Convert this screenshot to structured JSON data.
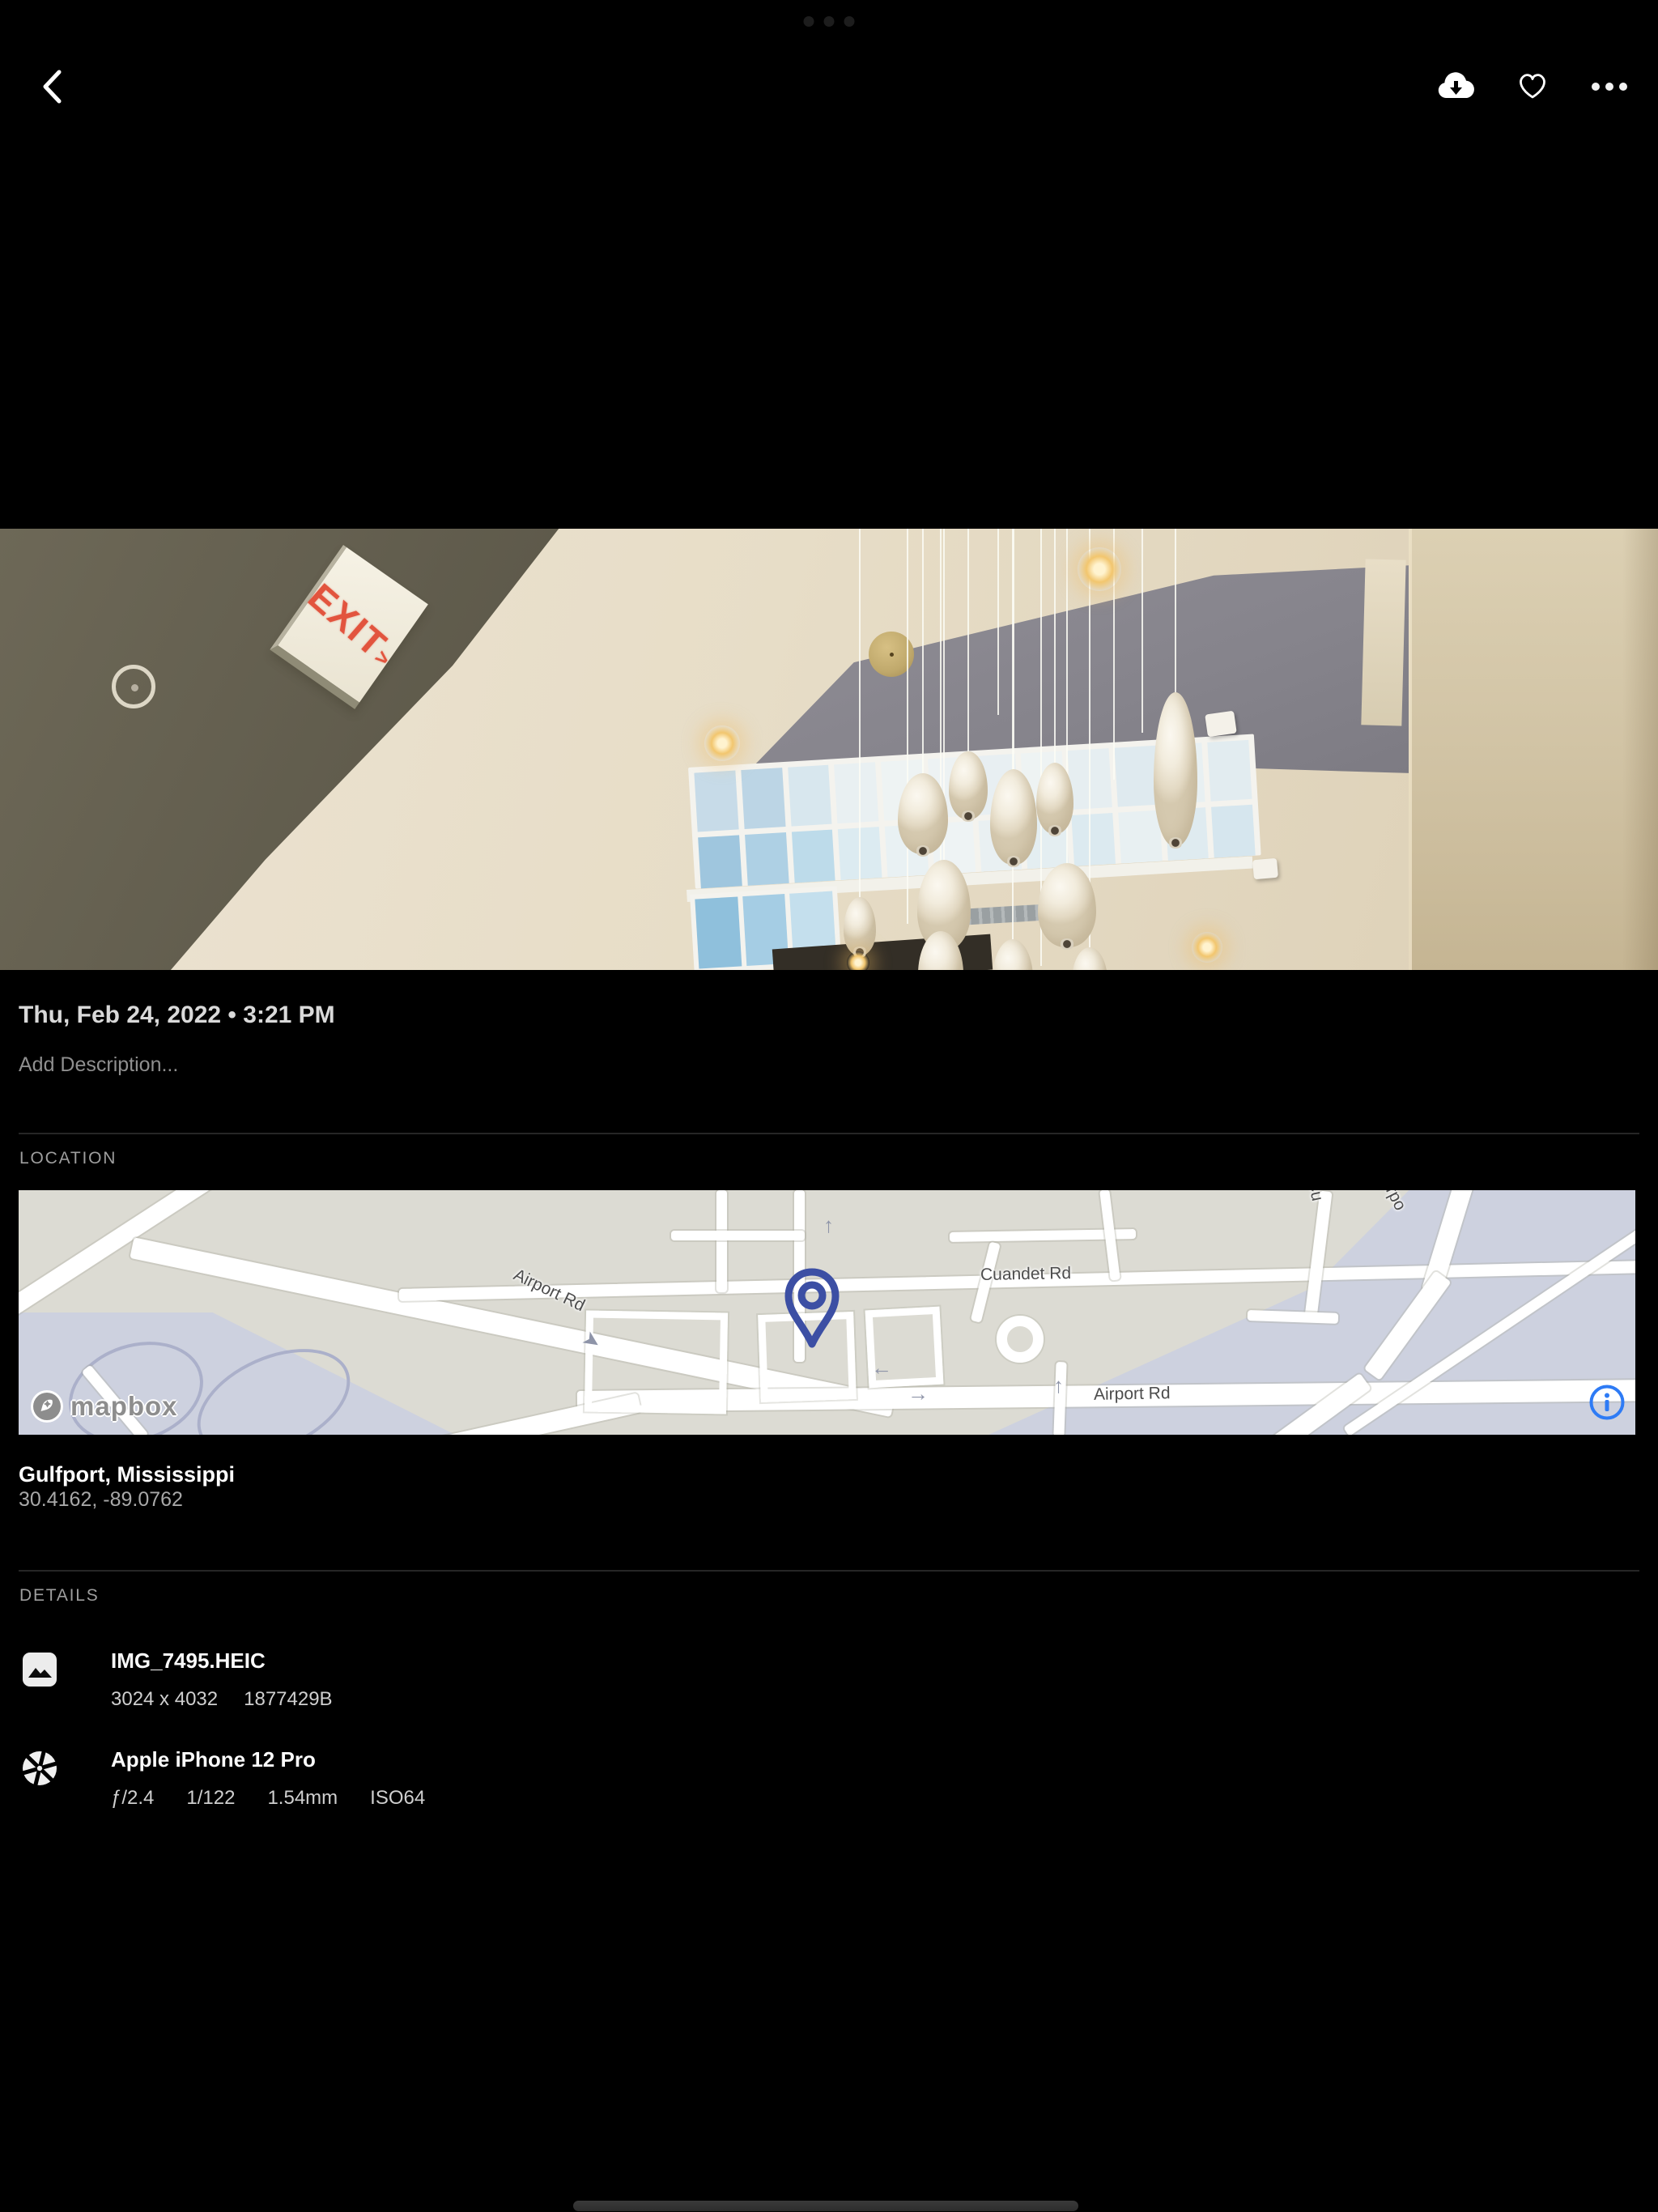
{
  "top_bar": {
    "back_icon": "chevron-left",
    "download_icon": "cloud-download",
    "favorite_icon": "heart-outline",
    "more_icon": "ellipsis"
  },
  "photo": {
    "exit_sign_text": "EXIT",
    "exit_sign_arrow": ">"
  },
  "metadata": {
    "date_time": "Thu, Feb 24, 2022 • 3:21 PM",
    "description_placeholder": "Add Description..."
  },
  "location": {
    "section_label": "LOCATION",
    "place": "Gulfport, Mississippi",
    "coordinates": "30.4162, -89.0762",
    "map": {
      "road_labels": [
        "Airport Rd",
        "Cuandet Rd",
        "Airport Rd",
        "Airpo",
        "Cu"
      ],
      "attribution": "mapbox",
      "info_icon": "i"
    }
  },
  "details": {
    "section_label": "DETAILS",
    "items": [
      {
        "icon": "image-icon",
        "title": "IMG_7495.HEIC",
        "subtitle_parts": [
          "3024 x 4032",
          "1877429B"
        ]
      },
      {
        "icon": "aperture-icon",
        "title": "Apple iPhone 12 Pro",
        "subtitle_parts": [
          "ƒ/2.4",
          "1/122",
          "1.54mm",
          "ISO64"
        ]
      }
    ]
  },
  "colors": {
    "background": "#000000",
    "info_icon_blue": "#2e7bf5",
    "map_pin_indigo": "#3c4fa4",
    "exit_sign_red": "#e2543e"
  }
}
